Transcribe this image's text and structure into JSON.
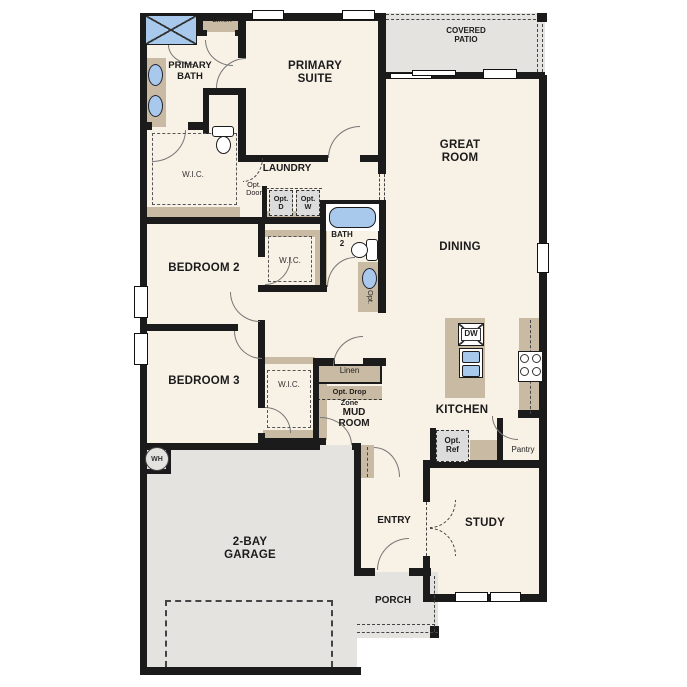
{
  "title": "Single-story floor plan",
  "colors": {
    "wall": "#1b1b1b",
    "floor": "#f8f1e6",
    "cabinet_tan": "#c9bba3",
    "exterior_gray": "#e4e3e0",
    "appliance_gray": "#dcdcdc",
    "fixture_blue": "#a9c9ec"
  },
  "rooms": {
    "covered_patio": {
      "label_line1": "COVERED",
      "label_line2": "PATIO"
    },
    "great_room": {
      "label_line1": "GREAT",
      "label_line2": "ROOM"
    },
    "dining": {
      "label": "DINING"
    },
    "kitchen": {
      "label": "KITCHEN"
    },
    "primary_suite": {
      "label_line1": "PRIMARY",
      "label_line2": "SUITE"
    },
    "primary_bath": {
      "label_line1": "PRIMARY",
      "label_line2": "BATH"
    },
    "primary_wic": {
      "label": "W.I.C."
    },
    "laundry": {
      "label": "LAUNDRY"
    },
    "bath2": {
      "label_line1": "BATH",
      "label_line2": "2"
    },
    "bedroom2": {
      "label": "BEDROOM 2"
    },
    "bedroom2_wic": {
      "label": "W.I.C."
    },
    "bedroom3": {
      "label": "BEDROOM 3"
    },
    "bedroom3_wic": {
      "label": "W.I.C."
    },
    "mud_room": {
      "label_line1": "MUD",
      "label_line2": "ROOM"
    },
    "entry": {
      "label": "ENTRY"
    },
    "study": {
      "label": "STUDY"
    },
    "porch": {
      "label": "PORCH"
    },
    "garage": {
      "label_line1": "2-BAY",
      "label_line2": "GARAGE"
    }
  },
  "features": {
    "linen_hall": {
      "label": "Linen"
    },
    "linen_mud": {
      "label": "Linen"
    },
    "opt_drop_zone": {
      "label_line1": "Opt. Drop",
      "label_line2": "Zone"
    },
    "opt_door": {
      "label_line1": "Opt.",
      "label_line2": "Door"
    },
    "opt_dryer": {
      "label_line1": "Opt.",
      "label_line2": "D"
    },
    "opt_washer": {
      "label_line1": "Opt.",
      "label_line2": "W"
    },
    "opt_ref": {
      "label_line1": "Opt.",
      "label_line2": "Ref"
    },
    "opt_bath2_sink": {
      "label": "Opt."
    },
    "pantry": {
      "label": "Pantry"
    },
    "dishwasher": {
      "label": "DW"
    },
    "water_heater": {
      "label": "WH"
    }
  }
}
